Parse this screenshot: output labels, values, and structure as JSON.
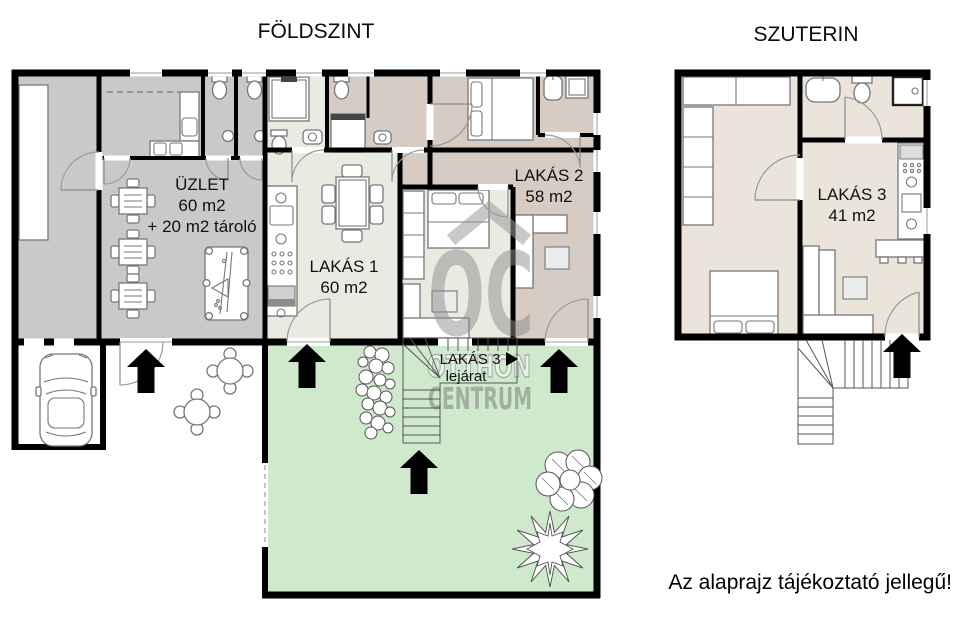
{
  "titles": {
    "ground_floor": "FÖLDSZINT",
    "basement": "SZUTERIN"
  },
  "rooms": {
    "shop": {
      "name": "ÜZLET",
      "area": "60 m2",
      "note": "+ 20 m2 tároló"
    },
    "flat1": {
      "name": "LAKÁS 1",
      "area": "60 m2"
    },
    "flat2": {
      "name": "LAKÁS 2",
      "area": "58 m2"
    },
    "flat3": {
      "name": "LAKÁS 3",
      "area": "41 m2"
    }
  },
  "stairs_label": {
    "name": "LAKÁS 3",
    "text": "lejárat"
  },
  "watermark": {
    "monogram": "OC",
    "word1": "OTTHON",
    "word2": "CENTRUM"
  },
  "disclaimer": "Az alaprajz tájékoztató jellegű!",
  "colors": {
    "wall": "#000000",
    "shop_fill": "#c9c9c9",
    "flat1_fill": "#e9ebe3",
    "flat2_fill": "#d6ccc4",
    "flat3_fill": "#ebe4da",
    "garden_fill": "#cfe9cd",
    "watermark_gray": "#9a9a9a"
  }
}
